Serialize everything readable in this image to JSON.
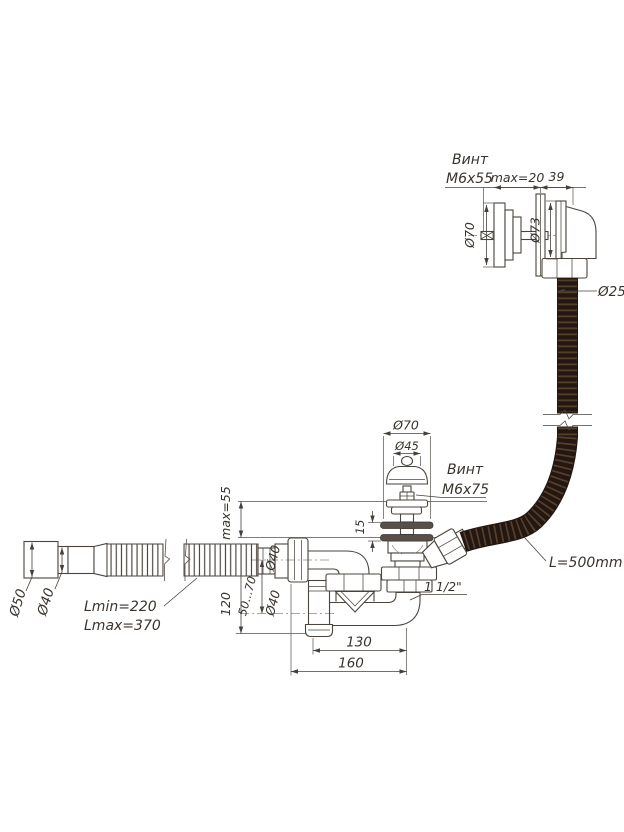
{
  "drawing_type": "bath-siphon-technical-drawing",
  "colors": {
    "line": "#4a443d",
    "dimension": "#45403a",
    "text": "#39332d",
    "hose": "#241711",
    "hose_ridge": "#55402c",
    "background": "#ffffff"
  },
  "overflow_head": {
    "note_l1": "Винт",
    "note_l2": "M6x55",
    "dim_wall": "max=20",
    "dim_len": "39",
    "dia_plate": "Ø70",
    "dia_body": "Ø73",
    "dia_hose": "Ø25"
  },
  "drain": {
    "dia_washer": "Ø70",
    "dia_cap": "Ø45",
    "note_l1": "Винт",
    "note_l2": "M6x75",
    "gap": "15",
    "depth_max": "max=55",
    "thread": "1 1/2\""
  },
  "hose": {
    "length": "L=500mm"
  },
  "outlet": {
    "dia_cuff": "Ø50",
    "dia_tube": "Ø40",
    "len_min": "Lmin=220",
    "len_max": "Lmax=370"
  },
  "siphon": {
    "span_inner": "130",
    "span_outer": "160",
    "height": "120",
    "adjust": "50...70",
    "dia_outlet": "Ø40",
    "dia_bottom": "Ø40"
  }
}
